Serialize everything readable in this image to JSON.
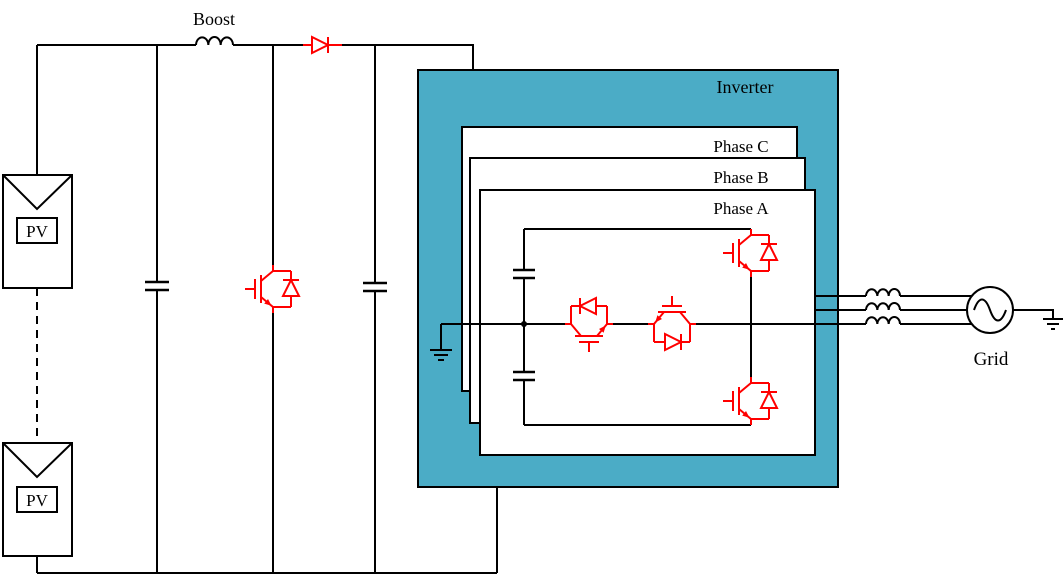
{
  "labels": {
    "boost": "Boost",
    "inverter": "Inverter",
    "grid": "Grid",
    "pv_module": "PV"
  },
  "phase_panels": [
    {
      "label": "Phase C"
    },
    {
      "label": "Phase B"
    },
    {
      "label": "Phase A"
    }
  ],
  "colors": {
    "inverter_fill": "#4BACC6",
    "panel_fill": "#FFFFFF",
    "component_highlight": "#FF0000",
    "wire": "#000000",
    "background": "#FFFFFF"
  },
  "icons": {
    "pv-module": "rectangle-with-chevron",
    "inductor": "three-bump-coil",
    "capacitor": "parallel-plates",
    "igbt": "igbt-with-antiparallel-diode",
    "diode": "triangle-with-bar",
    "ground": "stacked-shrinking-bars",
    "ac-source": "circle-with-sine-wave"
  }
}
